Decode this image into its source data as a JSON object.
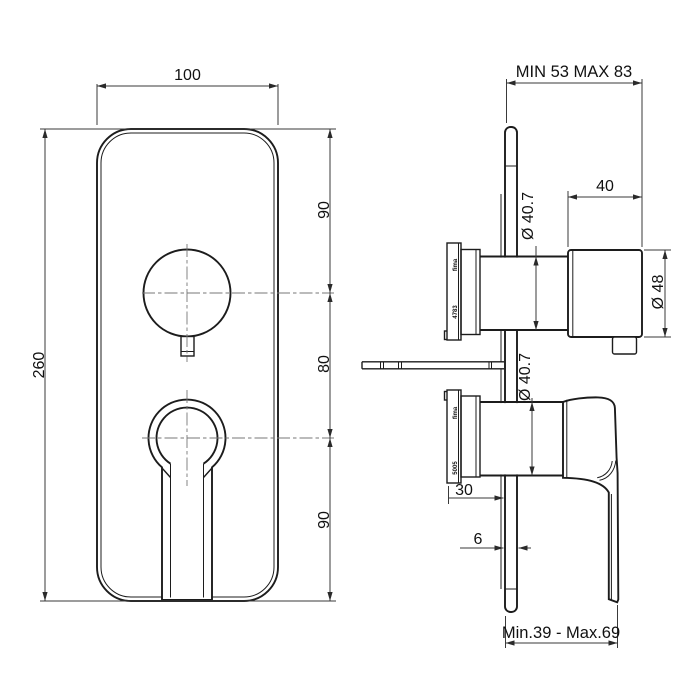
{
  "drawing_title": "concealed shower mixer technical drawing",
  "front_view": {
    "width": "100",
    "height": "260",
    "top_to_knob_center": "90",
    "knob_to_lever_center": "80",
    "lever_center_to_bottom": "90"
  },
  "side_view": {
    "wall_depth_range": "MIN 53 MAX 83",
    "knob_depth": "40",
    "knob_diameter": "Ø 48",
    "upper_body_diameter": "Ø 40.7",
    "lower_body_diameter": "Ø 40.7",
    "cartridge_to_wall": "30",
    "plate_thickness": "6",
    "handle_projection_range": "Min.39 - Max.69",
    "upper_cartridge": {
      "brand": "fima",
      "code": "4783"
    },
    "lower_cartridge": {
      "brand": "fima",
      "code": "5005"
    }
  }
}
